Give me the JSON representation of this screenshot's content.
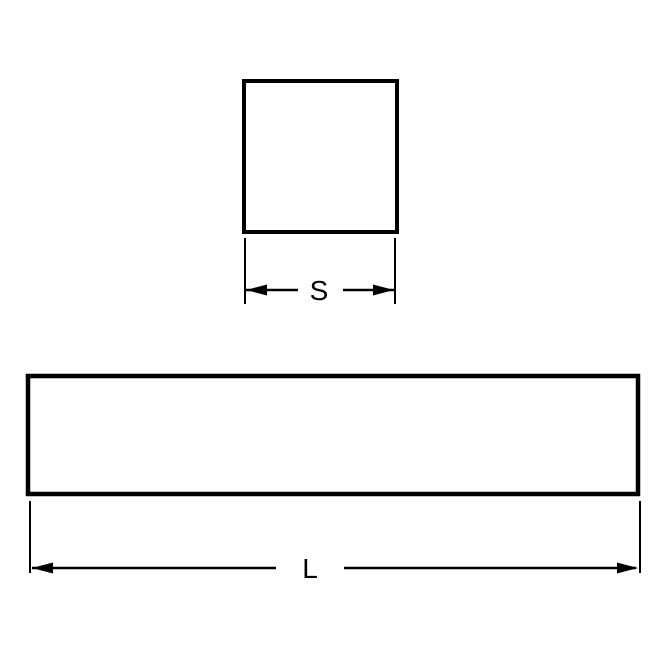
{
  "diagram": {
    "description": "Technical dimension drawing of square key steel: square cross-section and long rectangular bar side view",
    "line_color": "#000000",
    "background_color": "#ffffff",
    "cross_section": {
      "shape": "square",
      "dimension_label": "S"
    },
    "side_view": {
      "shape": "long-rectangle",
      "dimension_label": "L"
    }
  }
}
